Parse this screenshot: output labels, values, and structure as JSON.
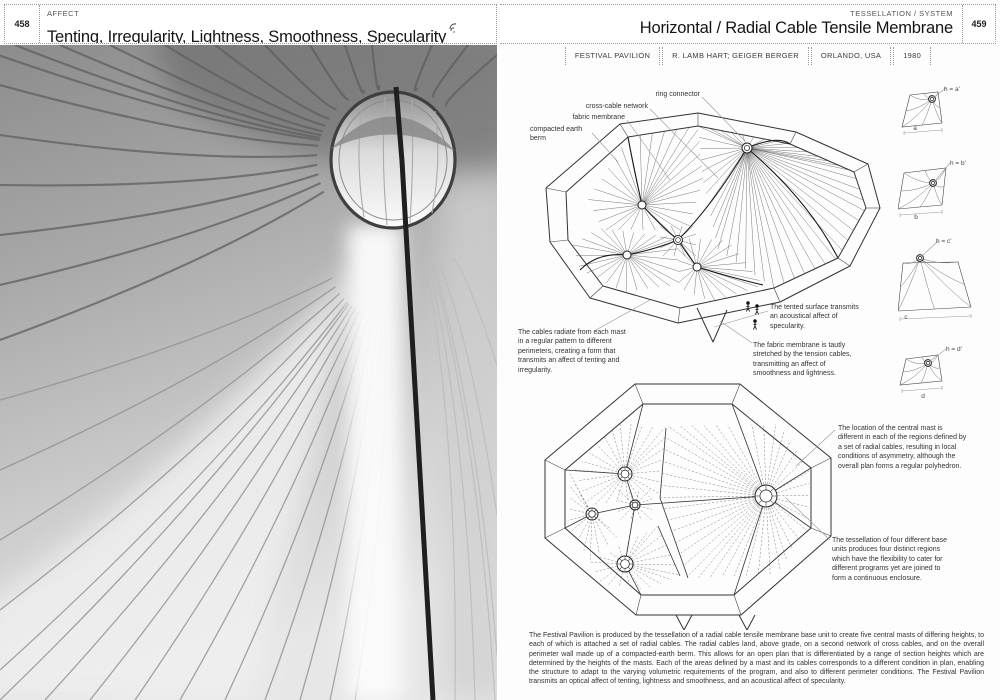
{
  "left_page": {
    "page_number": "458",
    "section": "AFFECT",
    "title": "Tenting, Irregularity, Lightness, Smoothness, Specularity"
  },
  "right_page": {
    "page_number": "459",
    "section": "TESSELLATION / SYSTEM",
    "title": "Horizontal / Radial Cable Tensile Membrane",
    "project": {
      "name": "FESTIVAL PAVILION",
      "architect": "R. LAMB HART; GEIGER BERGER",
      "location": "ORLANDO, USA",
      "year": "1980"
    },
    "axon_labels": {
      "ring_connector": "ring connector",
      "cross_cable_network": "cross-cable network",
      "fabric_membrane": "fabric membrane",
      "compacted_earth_berm": "compacted earth berm"
    },
    "annotations": {
      "cables_radiate": "The cables radiate from each mast in a regular pattern to different perimeters, creating a form that transmits an affect of tenting and irregularity.",
      "tented_surface": "The tented surface transmits an acoustical affect of specularity.",
      "fabric_membrane_taut": "The fabric membrane is tautly stretched by the tension cables, transmitting an affect of smoothness and lightness.",
      "central_mast": "The location of the central mast is different in each of the regions defined by a set of radial cables, resulting in local conditions of asymmetry, although the overall plan forms a regular polyhedron.",
      "tessellation_units": "The tessellation of four different base units produces four distinct regions which have the flexibility to cater for different programs yet are joined to form a continuous enclosure."
    },
    "unit_diagrams": [
      {
        "height_label": "h = a'",
        "base_label": "a"
      },
      {
        "height_label": "h = b'",
        "base_label": "b"
      },
      {
        "height_label": "h = c'",
        "base_label": "c"
      },
      {
        "height_label": "h = d'",
        "base_label": "d"
      }
    ],
    "body_text": "The Festival Pavilion is produced by the tessellation of a radial cable tensile membrane base unit to create five central masts of differing heights, to each of which is attached a set of radial cables. The radial cables land, above grade, on a second network of cross cables, and on the overall perimeter wall made up of a compacted-earth berm. This allows for an open plan that is differentiated by a range of section heights which are determined by the heights of the masts. Each of the areas defined by a mast and its cables corresponds to a different condition in plan, enabling the structure to adapt to the varying volumetric requirements of the program, and also to different perimeter conditions. The Festival Pavilion transmits an optical affect of tenting, lightness and smoothness, and an acoustical affect of specularity."
  }
}
